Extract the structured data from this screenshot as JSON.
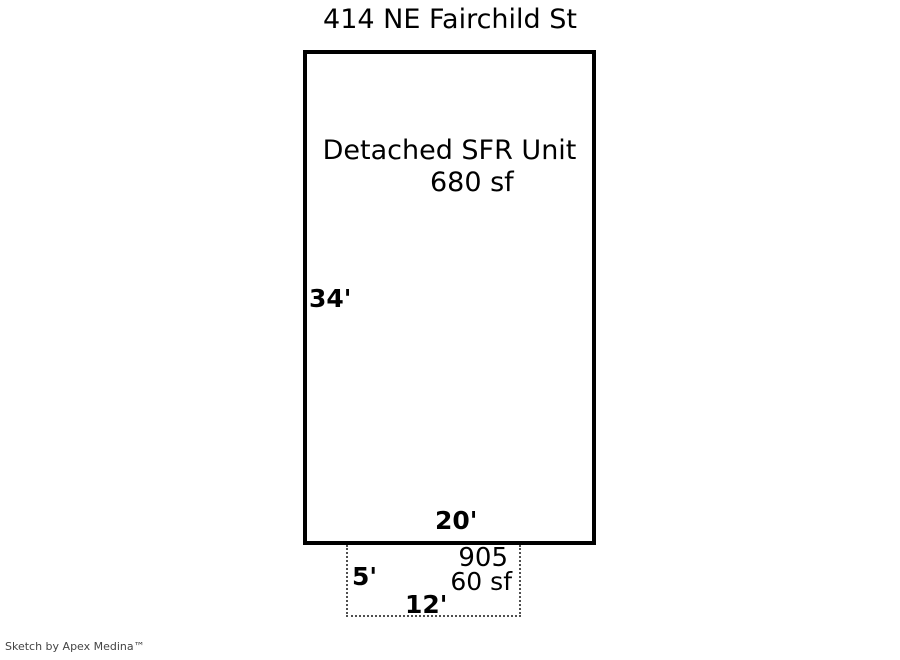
{
  "page": {
    "title": "414 NE Fairchild St",
    "footer": "Sketch by Apex Medina™"
  },
  "main_unit": {
    "name": "Detached SFR Unit",
    "area": "680 sf",
    "left_dim": "34'",
    "bottom_dim": "20'",
    "width_ft": 20,
    "height_ft": 34
  },
  "accessory_structure": {
    "name": "905",
    "area": "60 sf",
    "left_dim": "5'",
    "bottom_dim": "12'",
    "width_ft": 12,
    "height_ft": 5
  },
  "colors": {
    "background": "#ffffff",
    "solid_line": "#000000",
    "dotted_line": "#4f4f4f",
    "text": "#000000",
    "footer_text": "#444444"
  }
}
